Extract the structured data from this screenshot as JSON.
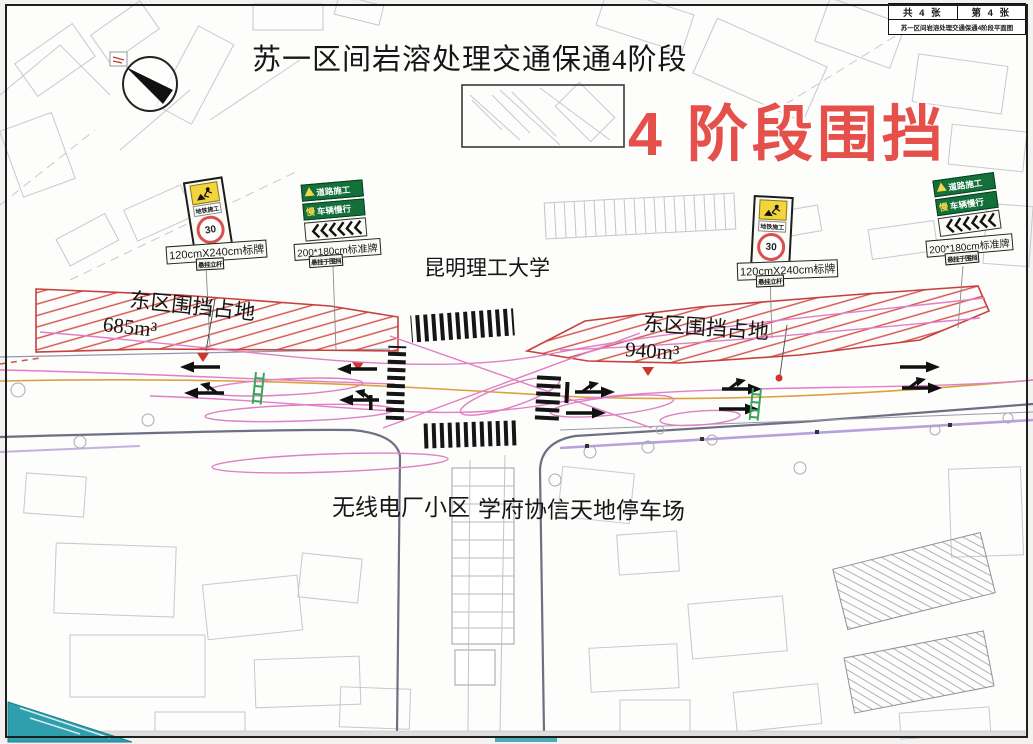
{
  "titleblock": {
    "sheet_total": "共 4 张",
    "sheet_index": "第 4 张",
    "drawing_name": "苏一区间岩溶处理交通保通4阶段平面图"
  },
  "header": {
    "main_title": "苏一区间岩溶处理交通保通4阶段",
    "stage_banner": "4 阶段围挡"
  },
  "map": {
    "university": "昆明理工大学",
    "zone_west": {
      "title": "东区围挡占地",
      "area": "685m³"
    },
    "zone_east": {
      "title": "东区围挡占地",
      "area": "940m³"
    },
    "residential": "无线电厂小区",
    "parking": "学府协信天地停车场"
  },
  "signs": {
    "metro": {
      "title": "地铁施工",
      "speed_limit": "30",
      "size_label": "120cmX240cm标牌",
      "note": "悬挂立杆"
    },
    "roadwork": {
      "line1": "道路施工",
      "slow_char": "慢",
      "line2": "车辆慢行",
      "size_label": "200*180cm标准牌",
      "note": "悬挂于围挡"
    }
  },
  "colors": {
    "banner_red": "#e5504b",
    "hatch_red": "#d4504b",
    "sign_green": "#14703a",
    "sign_yellow": "#f2d43c",
    "lane_orange": "#d9a23e",
    "path_pink": "#e07fc6",
    "teal": "#2f9fae"
  }
}
